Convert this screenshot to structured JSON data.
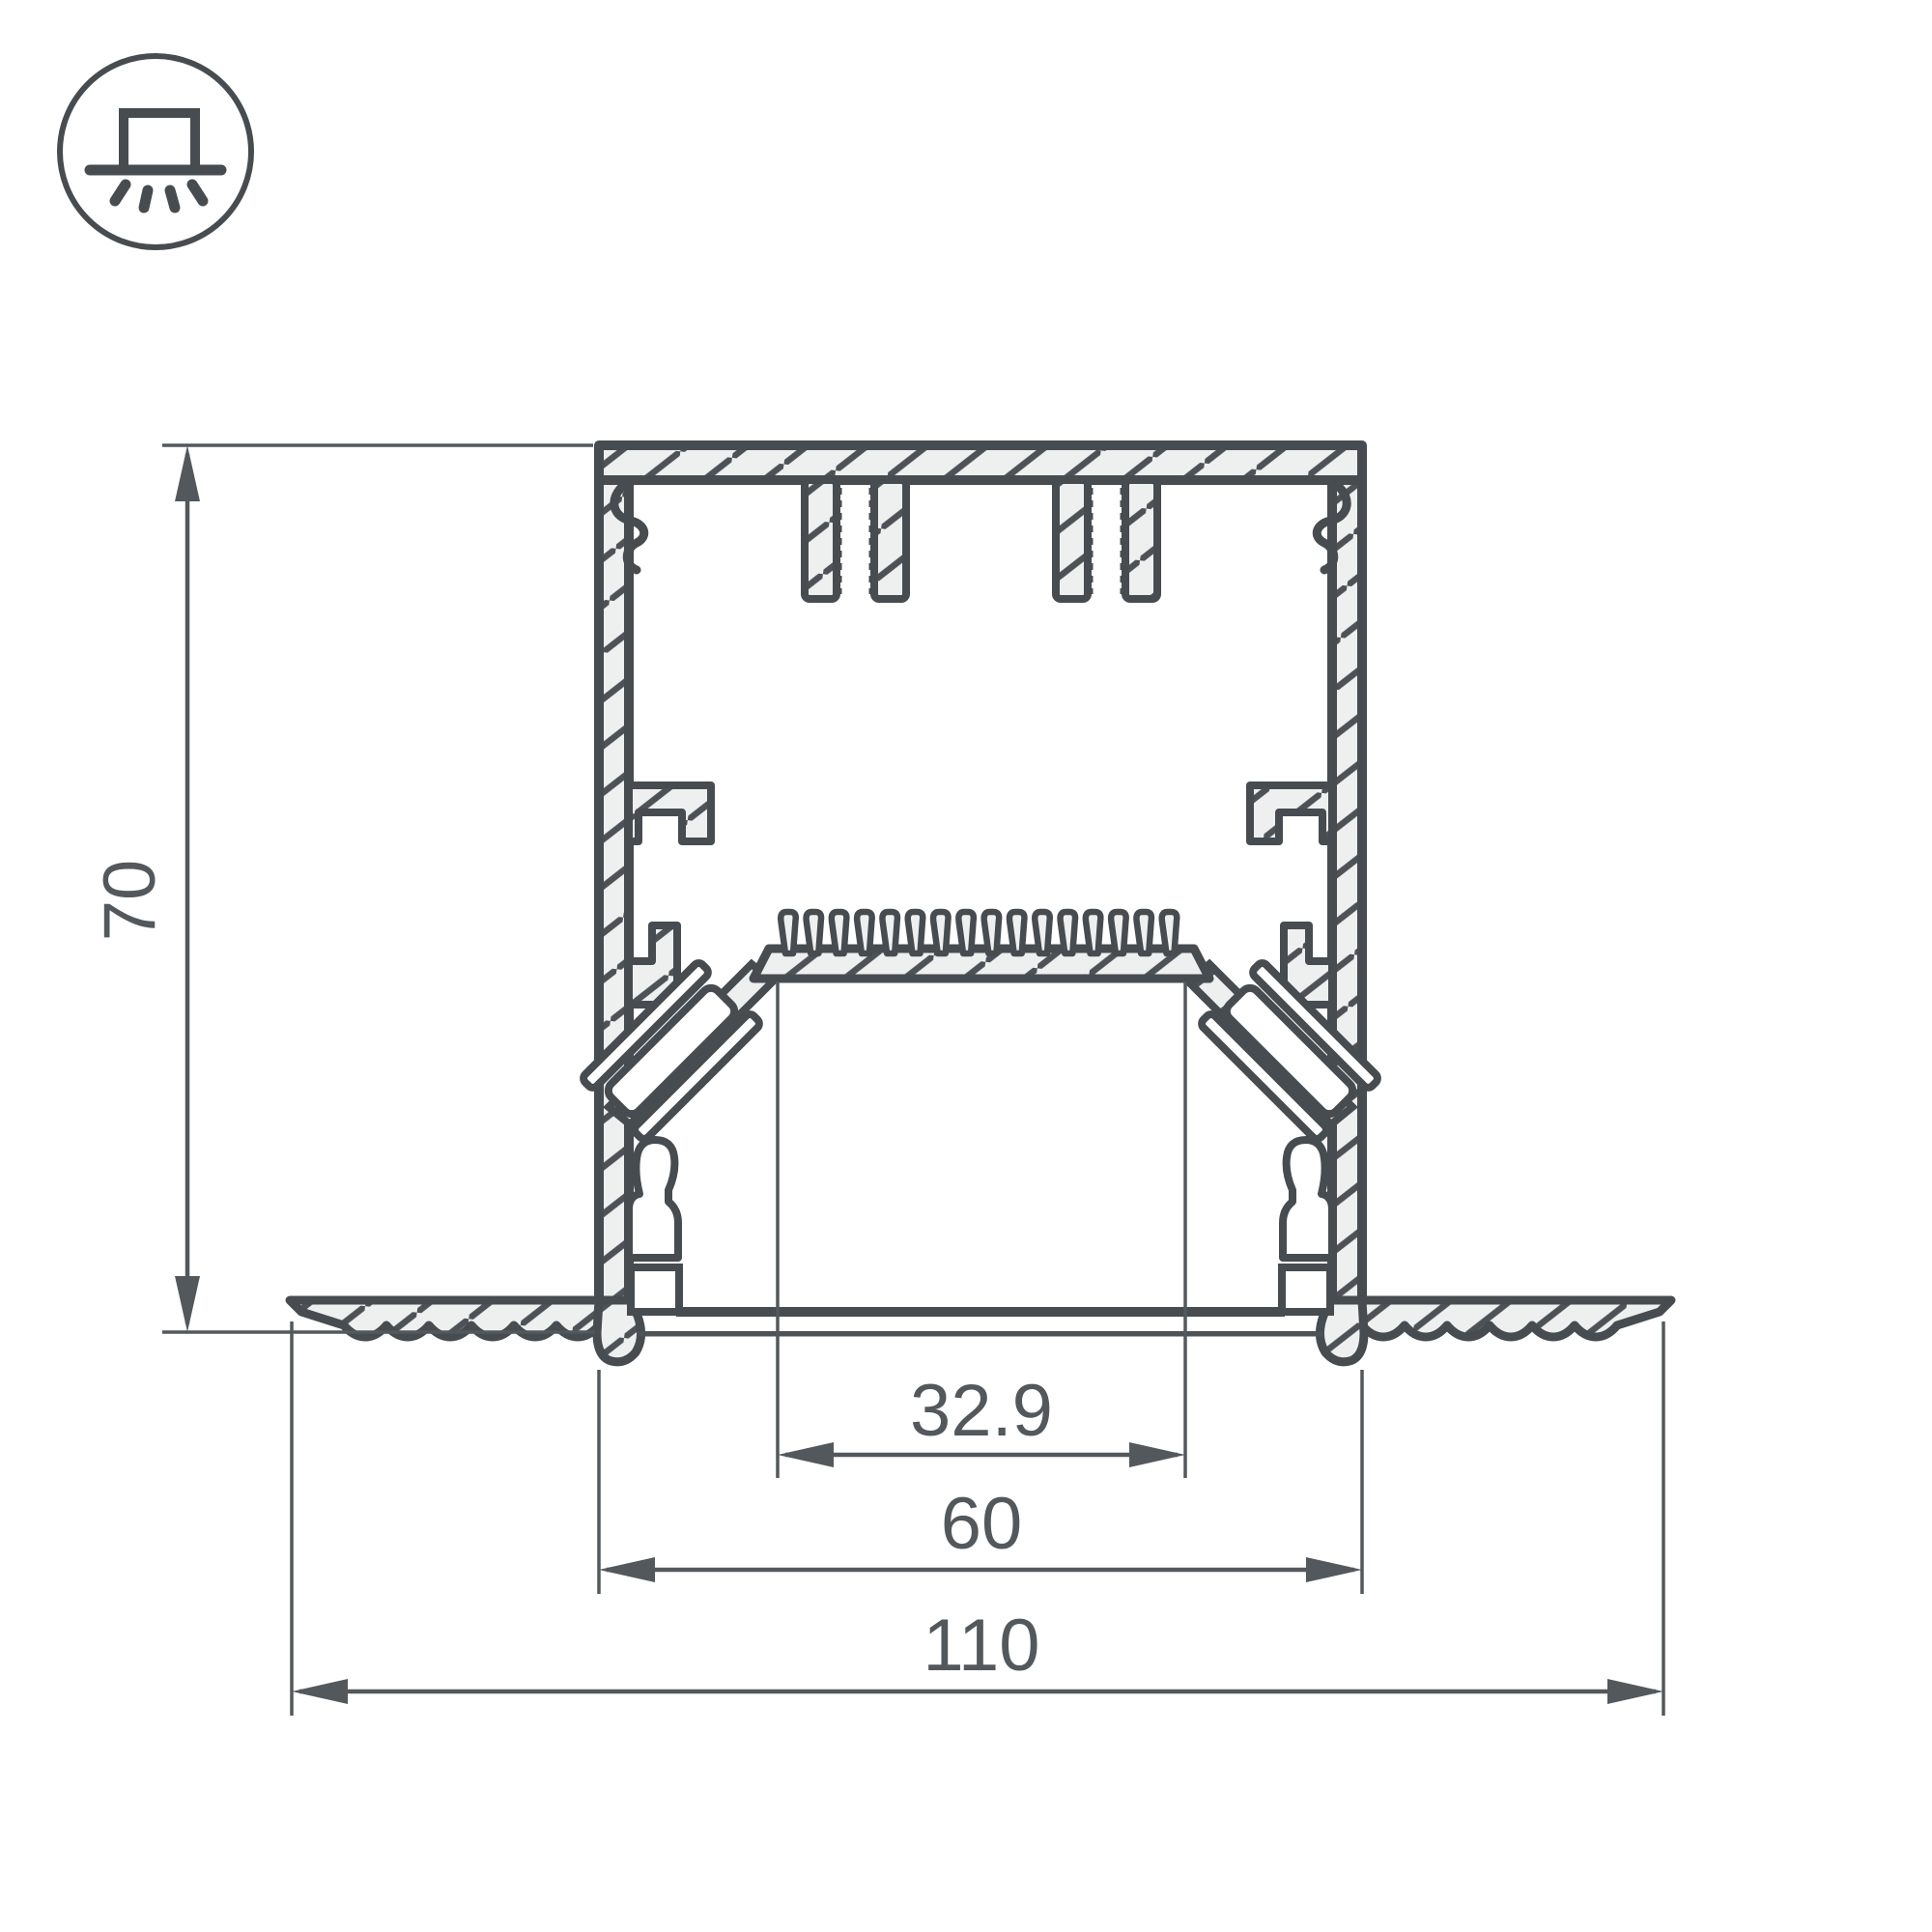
{
  "drawing": {
    "kind": "technical-cross-section",
    "subject": "recessed-linear-profile",
    "units": "mm"
  },
  "icon": {
    "name": "recessed-mount-light-icon"
  },
  "dimensions": {
    "height": "70",
    "inner_width": "32.9",
    "body_width": "60",
    "overall_width": "110"
  },
  "colors": {
    "outline": "#474c50",
    "dimension": "#53585c",
    "metal_fill": "#eef0f0",
    "background": "#ffffff"
  }
}
